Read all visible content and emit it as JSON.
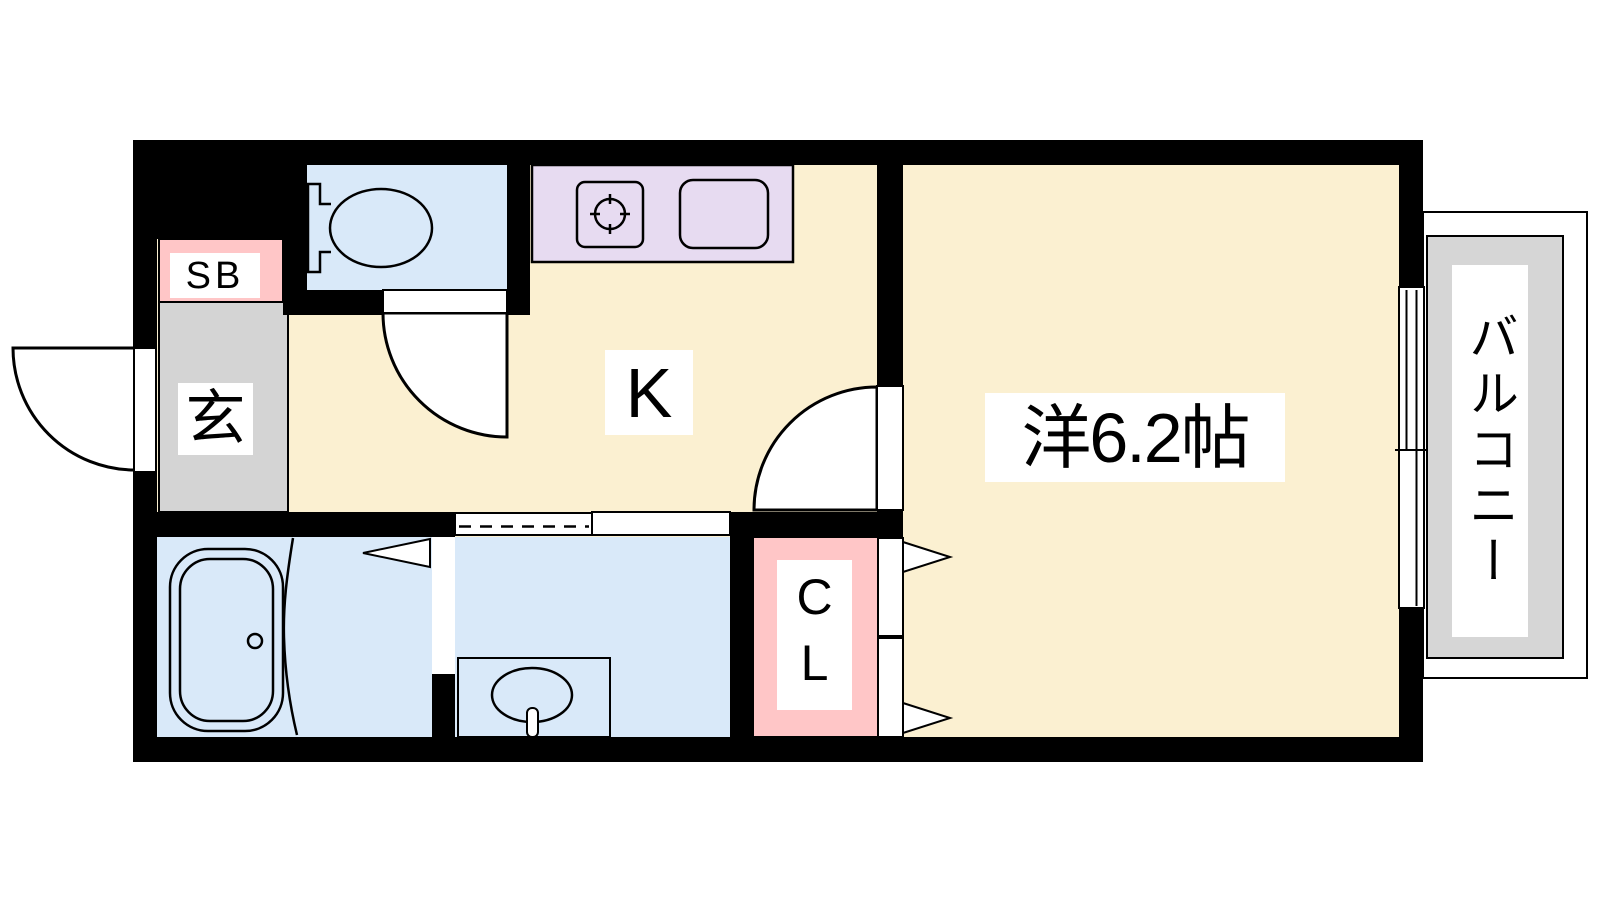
{
  "floorplan": {
    "rooms": {
      "western_room": {
        "label": "洋6.2帖"
      },
      "kitchen": {
        "label": "K"
      },
      "entrance": {
        "label": "玄"
      },
      "shoe_box": {
        "label": "SB"
      },
      "closet": {
        "label": "CL"
      },
      "balcony": {
        "label": "バルコニー"
      }
    },
    "colors": {
      "wall": "#000000",
      "floor": "#FBF0D1",
      "wet_area": "#D9E9F9",
      "kitchen_counter": "#E7DBF1",
      "storage": "#FFC6C7",
      "entrance_floor": "#D4D4D4",
      "balcony_floor": "#D6D6D6",
      "outline": "#000000",
      "background": "#FFFFFF"
    }
  }
}
